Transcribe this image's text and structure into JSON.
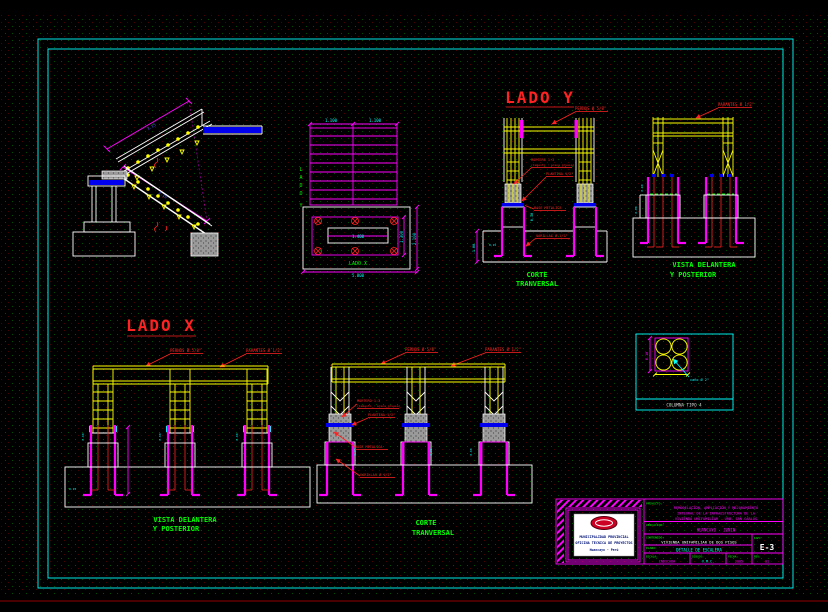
{
  "sheet": {
    "bg": "#000000",
    "border_color": "#00FFFF"
  },
  "titles": {
    "lado_y": "LADO Y",
    "lado_x": "LADO X"
  },
  "captions": {
    "corte_line1": "CORTE",
    "corte_line2": "TRANVERSAL",
    "vista_line1": "VISTA DELANTERA",
    "vista_line2": "Y POSTERIOR"
  },
  "annotations": {
    "pernos": "PERNOS Ø 5/8\"",
    "parantes": "PARANTES Ø 1/2\"",
    "mortero_line1": "MORTERO 1:3",
    "mortero_line2": "(Cemento : arena gruesa)",
    "plantina": "PLANTINA 1/2\"",
    "base_metalica": "BASE METALICA",
    "varillas": "VARILLAS Ø 1/2\""
  },
  "stair_view": {
    "dim_upper_flight": "3.15",
    "dim_lower_flight": "3.15"
  },
  "plan_view": {
    "lado_y_letters": [
      "L",
      "A",
      "D",
      "O",
      "Y"
    ],
    "lado_x_label": "LADO X",
    "dim_top_left": "1.100",
    "dim_top_right": "1.100",
    "dim_inner": "1.400",
    "dim_right_inner": "1.300",
    "dim_right_outer": "2.100",
    "dim_bottom": "5.800"
  },
  "corte_y_view": {
    "dim_pedestal": "0.30",
    "dim_footing": "-1.00",
    "dim_foot": "0.15"
  },
  "vista_y_view": {
    "dim_upper": "0.60",
    "dim_lower": "0.60"
  },
  "lado_x_view": {
    "dim_col_1": "0.60",
    "dim_col_2": "0.60",
    "dim_col_3": "0.60",
    "dim_base": "0.15"
  },
  "corte_x_view": {
    "dim_col_1": "0.60",
    "dim_col_2": "0.60",
    "dim_col_3": "0.60"
  },
  "columna_detail": {
    "caption": "COLUMNA TIPO 4",
    "dim_height": "0.10",
    "note": "caño Ø 2\""
  },
  "title_block": {
    "org_line1": "MUNICIPALIDAD PROVINCIAL",
    "org_line2": "OFICINA TECNICA DE PROYECTOS",
    "org_line3": "Huancayo - Perú",
    "proyecto_label": "PROYECTO:",
    "proyecto_line1": "REMODELACION, AMPLIACION Y MEJORAMIENTO",
    "proyecto_line2": "INTEGRAL DE LA INFRAESTRUCTURA DE LA",
    "proyecto_line3": "VIVIENDA UNIFAMILIAR - URB. SAN CARLOS",
    "ubicacion_label": "UBICACION:",
    "ubicacion_value": "HUANCAYO - JUNIN",
    "contenido_label": "CONTENIDO:",
    "contenido_value": "VIVIENDA UNIFAMILIAR DE DOS PISOS",
    "plano_label": "PLANO:",
    "plano_value": "DETALLE DE ESCALERA",
    "lam_label": "LAM:",
    "lam_value": "E-3",
    "escala_label": "ESCALA:",
    "escala_value": "INDICADA",
    "dibujo_label": "DIBUJO:",
    "dibujo_value": "V.M.C.",
    "fecha_label": "FECHA:",
    "fecha_value": "2005",
    "rev_label": "REV:",
    "rev_value": "01"
  }
}
